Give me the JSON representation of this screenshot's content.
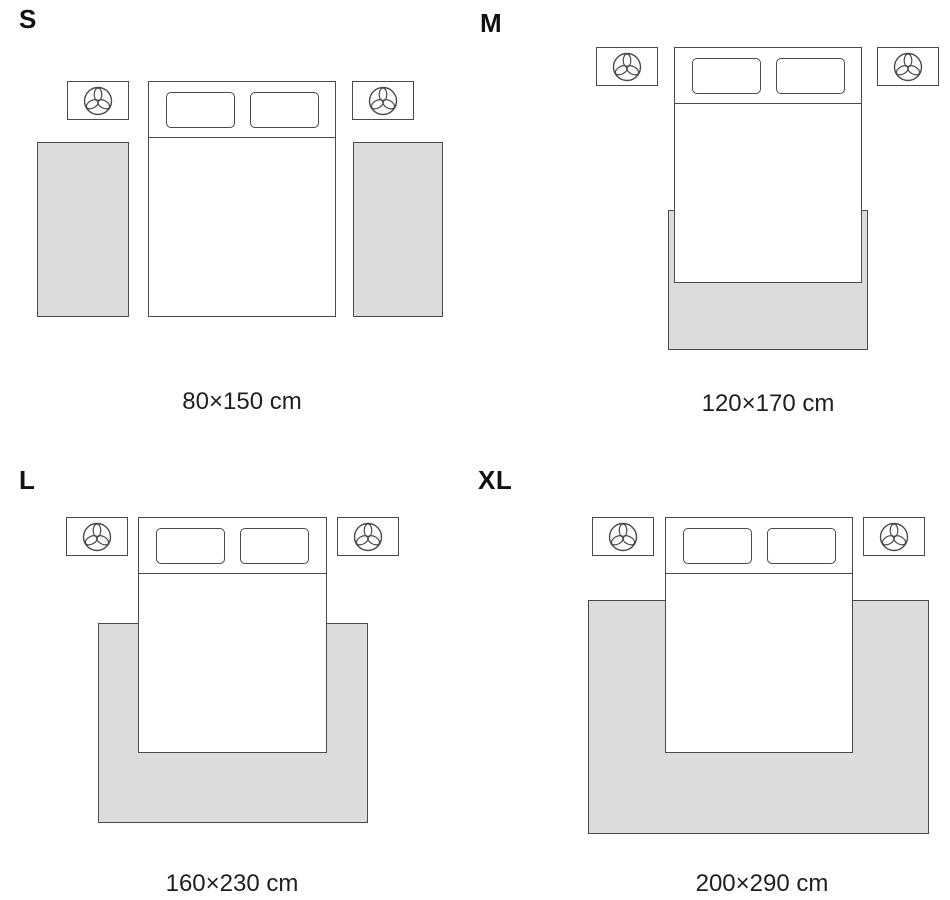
{
  "sizes": [
    {
      "label": "S",
      "dimensions": "80×150 cm"
    },
    {
      "label": "M",
      "dimensions": "120×170 cm"
    },
    {
      "label": "L",
      "dimensions": "160×230 cm"
    },
    {
      "label": "XL",
      "dimensions": "200×290 cm"
    }
  ],
  "colors": {
    "rug_fill": "#dcdcdc",
    "line": "#4a4a4a",
    "label_text": "#111111",
    "caption_text": "#1f1f1f"
  },
  "icons": {
    "nightstand_decor": "plant-icon"
  }
}
